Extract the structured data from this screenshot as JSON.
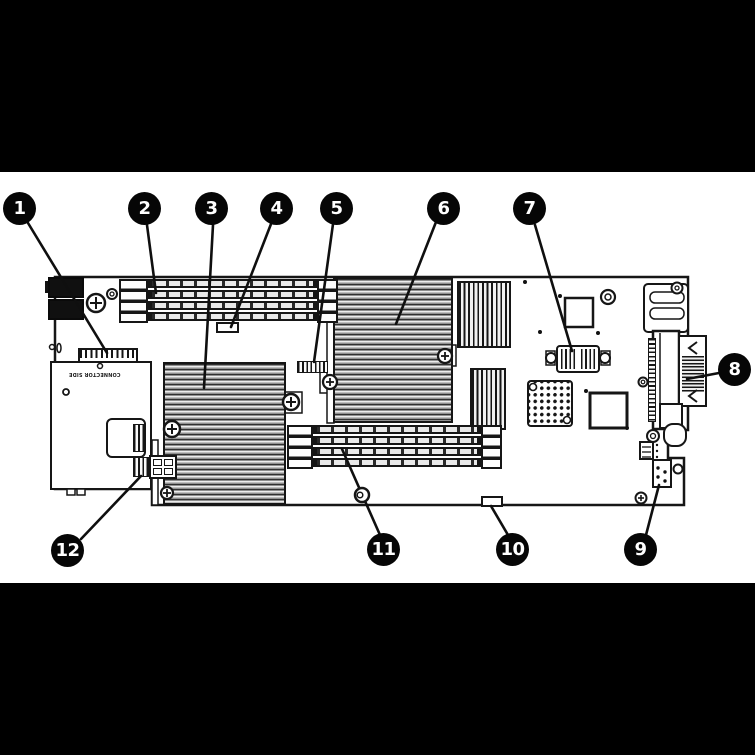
{
  "scene": {
    "figure_type": "motherboard-callout-diagram",
    "board_text": "CONNECTOR SIDE",
    "colors": {
      "letterbox": "#000000",
      "paper": "#ffffff",
      "ink": "#161616",
      "callout_bg": "#060606",
      "callout_text": "#ffffff"
    },
    "callouts": [
      {
        "label": "1",
        "target": "midplane-signal-connector"
      },
      {
        "label": "2",
        "target": "dimm-bank-top"
      },
      {
        "label": "3",
        "target": "processor-heatsink-left"
      },
      {
        "label": "4",
        "target": "board-connector-below-dimms"
      },
      {
        "label": "5",
        "target": "cpu-area-connector"
      },
      {
        "label": "6",
        "target": "processor-heatsink-center"
      },
      {
        "label": "7",
        "target": "mezzanine-socket"
      },
      {
        "label": "8",
        "target": "rear-io-connector"
      },
      {
        "label": "9",
        "target": "pin-header"
      },
      {
        "label": "10",
        "target": "bottom-edge-tab"
      },
      {
        "label": "11",
        "target": "dimm-bank-bottom"
      },
      {
        "label": "12",
        "target": "card-edge-connector"
      }
    ]
  }
}
